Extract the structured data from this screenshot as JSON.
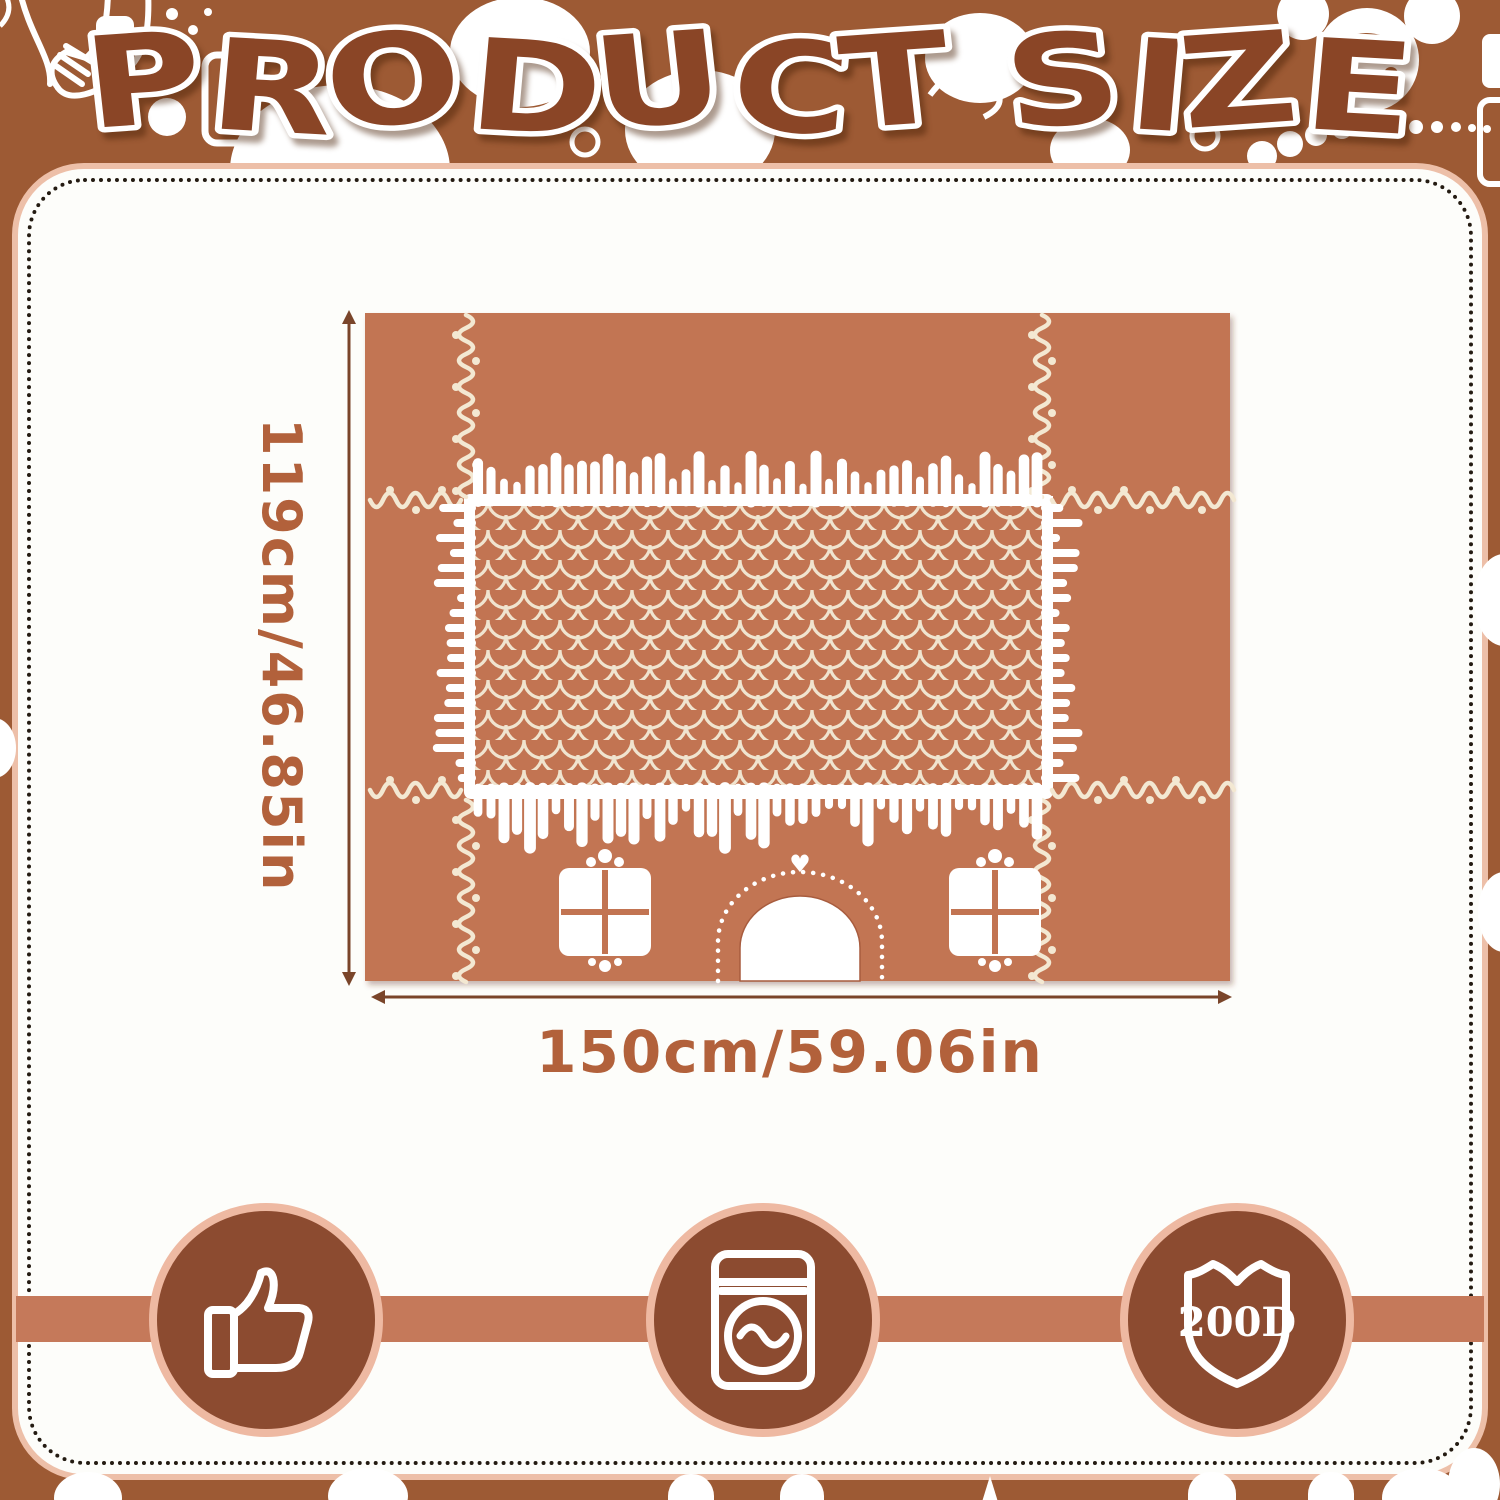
{
  "title": {
    "text": "PRODUCT SIZE"
  },
  "product": {
    "height_label": "119cm/46.85in",
    "width_label": "150cm/59.06in"
  },
  "badges": [
    {
      "name": "quality",
      "icon": "thumbs-up-icon"
    },
    {
      "name": "washable",
      "icon": "washing-machine-icon"
    },
    {
      "name": "durable",
      "icon": "shield-icon",
      "label": "200D"
    }
  ],
  "colors": {
    "background_brown": "#9d5a34",
    "title_brown": "#8a4526",
    "fabric_terracotta": "#c27452",
    "icing_white": "#ffffff",
    "icing_cream": "#f3e8d2",
    "dimension_text": "#b2613b",
    "badge_fill": "#8c4b30",
    "badge_ring": "#eeb9a2",
    "band_salmon": "#c5795a",
    "card_dot_border": "#241b12"
  }
}
